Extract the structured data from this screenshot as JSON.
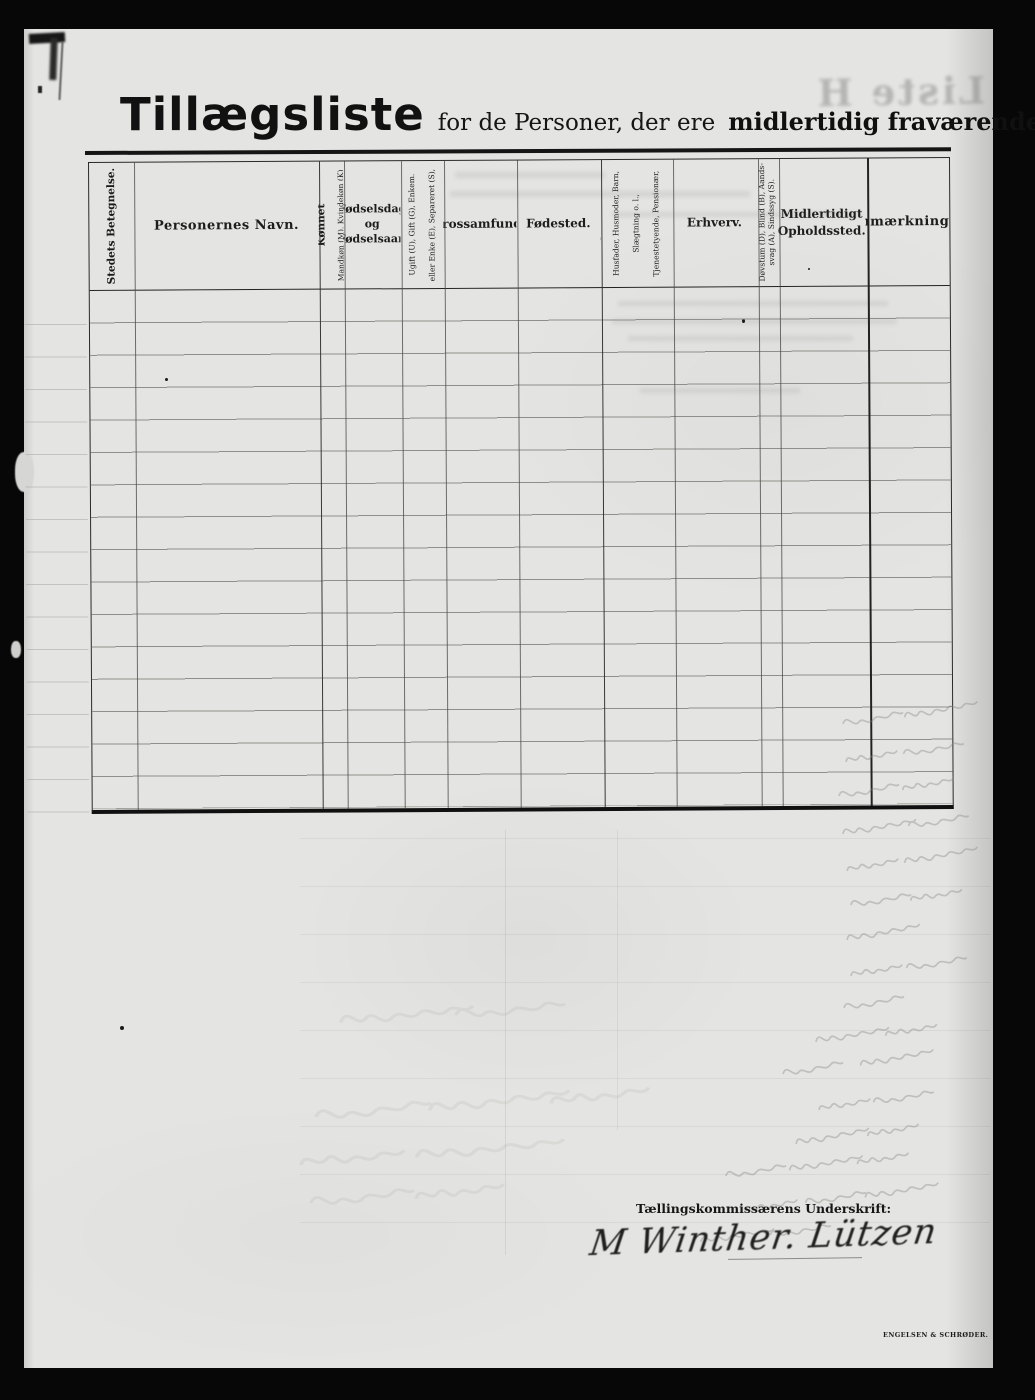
{
  "page": {
    "title": {
      "main": "Tillægsliste",
      "middle": "for de Personer, der ere",
      "emphasis": "midlertidig fraværende."
    },
    "table": {
      "body_rows": 16,
      "columns": [
        {
          "label": "Stedets Betegnelse.",
          "orientation": "vertical"
        },
        {
          "label": "Personernes Navn.",
          "orientation": "horizontal",
          "bold": true
        },
        {
          "label": "Kønnet",
          "sub": "Mandkøn (M), Kvindekøn (K)",
          "orientation": "vertical"
        },
        {
          "label": "Fødselsdag\nog\nFødselsaar.",
          "orientation": "horizontal"
        },
        {
          "label": "Ægteskabelig Stilling.",
          "sub": "Ugift (U), Gift (G), Enkem.\neller Enke (E), Separeret (S),\nFraskilt (F)",
          "orientation": "vertical"
        },
        {
          "label": "Trossamfund.",
          "orientation": "horizontal"
        },
        {
          "label": "Fødested.",
          "orientation": "horizontal"
        },
        {
          "label": "Stilling i Familien:",
          "sub": "Husfader, Husmoder, Barn,\nSlægtning o. l.,\nTjenestetyende, Pensionær,\nLogerende.",
          "orientation": "vertical"
        },
        {
          "label": "Erhverv.",
          "orientation": "horizontal"
        },
        {
          "label": "Døvstum (D), Blind (B), Aands-\nsvag (A), Sindssyg (S).",
          "orientation": "vertical"
        },
        {
          "label": "Midlertidigt\nOpholdssted.",
          "orientation": "horizontal"
        },
        {
          "label": "Anmærkninger",
          "orientation": "horizontal",
          "bold": true
        }
      ]
    },
    "signature": {
      "label": "Tællingskommissærens Underskrift:",
      "name": "M Winther. Lützen"
    },
    "ghost": {
      "mirrored_title": "Liste H",
      "printer_mark": "ENGELSEN & SCHRØDER."
    }
  }
}
